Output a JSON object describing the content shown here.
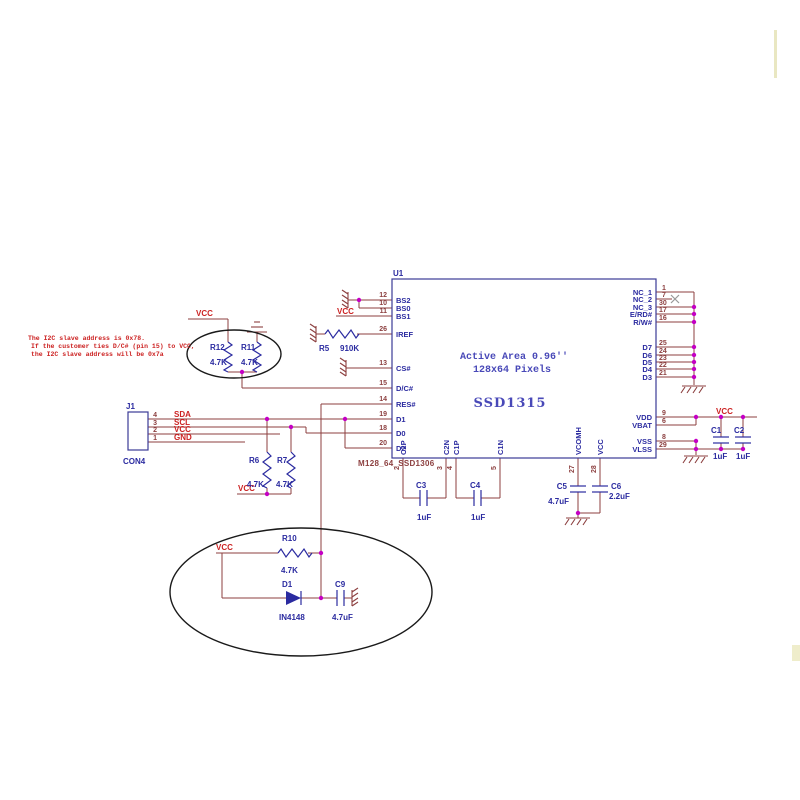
{
  "note": {
    "line1": "The I2C slave address is 0x78.",
    "line2": "If the customer ties D/C# (pin 15) to VCC,",
    "line3": "the I2C slave address will be 0x7a"
  },
  "ic": {
    "refdes": "U1",
    "part": "SSD1315",
    "area1": "Active Area 0.96''",
    "area2": "128x64 Pixels",
    "footprint": "M128_64_SSD1306",
    "left_pins": [
      {
        "num": "12",
        "name": "BS2"
      },
      {
        "num": "10",
        "name": "BS0"
      },
      {
        "num": "11",
        "name": "BS1"
      },
      {
        "num": "26",
        "name": "IREF"
      },
      {
        "num": "13",
        "name": "CS#"
      },
      {
        "num": "15",
        "name": "D/C#"
      },
      {
        "num": "14",
        "name": "RES#"
      },
      {
        "num": "19",
        "name": "D1"
      },
      {
        "num": "18",
        "name": "D0"
      },
      {
        "num": "20",
        "name": "D2"
      }
    ],
    "right_pins": [
      {
        "num": "1",
        "name": "NC_1"
      },
      {
        "num": "7",
        "name": "NC_2"
      },
      {
        "num": "30",
        "name": "NC_3"
      },
      {
        "num": "17",
        "name": "E/RD#"
      },
      {
        "num": "16",
        "name": "R/W#"
      },
      {
        "num": "25",
        "name": "D7"
      },
      {
        "num": "24",
        "name": "D6"
      },
      {
        "num": "23",
        "name": "D5"
      },
      {
        "num": "22",
        "name": "D4"
      },
      {
        "num": "21",
        "name": "D3"
      },
      {
        "num": "9",
        "name": "VDD"
      },
      {
        "num": "6",
        "name": "VBAT"
      },
      {
        "num": "8",
        "name": "VSS"
      },
      {
        "num": "29",
        "name": "VLSS"
      }
    ],
    "bottom_pins": [
      {
        "num": "2",
        "name": "C2P"
      },
      {
        "num": "3",
        "name": "C2N"
      },
      {
        "num": "4",
        "name": "C1P"
      },
      {
        "num": "5",
        "name": "C1N"
      },
      {
        "num": "27",
        "name": "VCOMH"
      },
      {
        "num": "28",
        "name": "VCC"
      }
    ]
  },
  "connector": {
    "refdes": "J1",
    "part": "CON4",
    "pins": [
      {
        "num": "4",
        "net": "SDA"
      },
      {
        "num": "3",
        "net": "SCL"
      },
      {
        "num": "2",
        "net": "VCC"
      },
      {
        "num": "1",
        "net": "GND"
      }
    ]
  },
  "components": {
    "r5": {
      "ref": "R5",
      "value": "910K"
    },
    "r6": {
      "ref": "R6",
      "value": "4.7K"
    },
    "r7": {
      "ref": "R7",
      "value": "4.7K"
    },
    "r10": {
      "ref": "R10",
      "value": "4.7K"
    },
    "r11": {
      "ref": "R11",
      "value": "4.7K"
    },
    "r12": {
      "ref": "R12",
      "value": "4.7K"
    },
    "c1": {
      "ref": "C1",
      "value": "1uF"
    },
    "c2": {
      "ref": "C2",
      "value": "1uF"
    },
    "c3": {
      "ref": "C3",
      "value": "1uF"
    },
    "c4": {
      "ref": "C4",
      "value": "1uF"
    },
    "c5": {
      "ref": "C5",
      "value": "4.7uF"
    },
    "c6": {
      "ref": "C6",
      "value": "2.2uF"
    },
    "c9": {
      "ref": "C9",
      "value": "4.7uF"
    },
    "d1": {
      "ref": "D1",
      "value": "IN4148"
    }
  },
  "net_labels": {
    "vcc": "VCC"
  },
  "colors": {
    "wire": "#8C3F3F",
    "component": "#2B2BA0",
    "red": "#CC2222",
    "junction": "#C400C4",
    "ic_text": "#4949B8",
    "outline": "#3B3B96"
  }
}
